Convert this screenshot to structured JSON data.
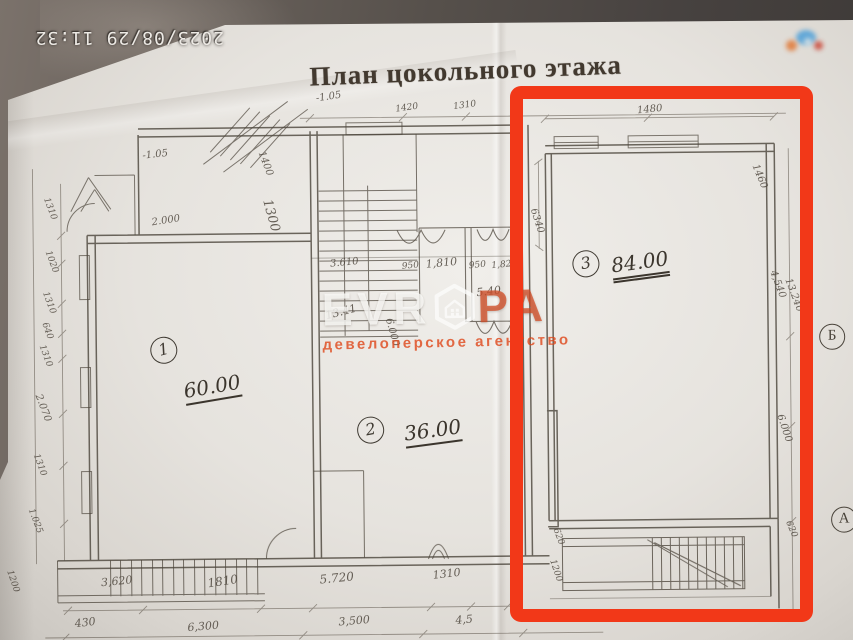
{
  "camera": {
    "timestamp": "2023/08/29  11:32"
  },
  "plan": {
    "title": "План цокольного этажа",
    "rooms": [
      {
        "number": "1",
        "area": "60.00"
      },
      {
        "number": "2",
        "area": "36.00"
      },
      {
        "number": "3",
        "area": "84.00"
      }
    ],
    "axis_markers": [
      "Б",
      "А"
    ],
    "dimensions": [
      {
        "t": "1420",
        "x": 409,
        "y": 108,
        "r": -7,
        "f": 9
      },
      {
        "t": "1310",
        "x": 467,
        "y": 106,
        "r": -7,
        "f": 9
      },
      {
        "t": "1480",
        "x": 652,
        "y": 112,
        "r": -5,
        "f": 10
      },
      {
        "t": "1460",
        "x": 761,
        "y": 180,
        "r": 68,
        "f": 10
      },
      {
        "t": "6340",
        "x": 538,
        "y": 222,
        "r": 73,
        "f": 10
      },
      {
        "t": "-1.05",
        "x": 331,
        "y": 96,
        "r": -8,
        "f": 10
      },
      {
        "t": "-1.05",
        "x": 157,
        "y": 152,
        "r": -6,
        "f": 10
      },
      {
        "t": "1400",
        "x": 267,
        "y": 162,
        "r": 70,
        "f": 10
      },
      {
        "t": "1300",
        "x": 272,
        "y": 214,
        "r": 75,
        "f": 13
      },
      {
        "t": "2.000",
        "x": 167,
        "y": 218,
        "r": -8,
        "f": 10
      },
      {
        "t": "1310",
        "x": 51,
        "y": 205,
        "r": 70,
        "f": 9
      },
      {
        "t": "1020",
        "x": 52,
        "y": 258,
        "r": 70,
        "f": 9
      },
      {
        "t": "1310",
        "x": 49,
        "y": 299,
        "r": 70,
        "f": 9
      },
      {
        "t": "640",
        "x": 47,
        "y": 327,
        "r": 70,
        "f": 9
      },
      {
        "t": "1310",
        "x": 45,
        "y": 352,
        "r": 70,
        "f": 9
      },
      {
        "t": "2.070",
        "x": 42,
        "y": 404,
        "r": 70,
        "f": 10
      },
      {
        "t": "1310",
        "x": 38,
        "y": 461,
        "r": 70,
        "f": 9
      },
      {
        "t": "1.025",
        "x": 33,
        "y": 517,
        "r": 70,
        "f": 9
      },
      {
        "t": "1200",
        "x": 10,
        "y": 577,
        "r": 72,
        "f": 9
      },
      {
        "t": "3.610",
        "x": 345,
        "y": 262,
        "r": -5,
        "f": 10
      },
      {
        "t": "950",
        "x": 411,
        "y": 266,
        "r": -5,
        "f": 9
      },
      {
        "t": "1,810",
        "x": 442,
        "y": 263,
        "r": -5,
        "f": 11
      },
      {
        "t": "950",
        "x": 478,
        "y": 266,
        "r": -5,
        "f": 9
      },
      {
        "t": "1,82",
        "x": 502,
        "y": 266,
        "r": -5,
        "f": 9
      },
      {
        "t": "5.40",
        "x": 489,
        "y": 292,
        "r": -6,
        "f": 11
      },
      {
        "t": "13.41",
        "x": 341,
        "y": 311,
        "r": -14,
        "f": 11
      },
      {
        "t": "6.000",
        "x": 392,
        "y": 332,
        "r": 75,
        "f": 10
      },
      {
        "t": "4,540",
        "x": 778,
        "y": 288,
        "r": 70,
        "f": 10
      },
      {
        "t": "13.240",
        "x": 794,
        "y": 299,
        "r": 70,
        "f": 10
      },
      {
        "t": "6.000",
        "x": 783,
        "y": 432,
        "r": 72,
        "f": 10
      },
      {
        "t": "620",
        "x": 789,
        "y": 533,
        "r": 68,
        "f": 9
      },
      {
        "t": "620",
        "x": 556,
        "y": 538,
        "r": 70,
        "f": 9
      },
      {
        "t": "1200",
        "x": 553,
        "y": 572,
        "r": 72,
        "f": 9
      },
      {
        "t": "3,620",
        "x": 114,
        "y": 578,
        "r": -5,
        "f": 11
      },
      {
        "t": "1810",
        "x": 220,
        "y": 579,
        "r": -8,
        "f": 12
      },
      {
        "t": "5.720",
        "x": 334,
        "y": 577,
        "r": -5,
        "f": 12
      },
      {
        "t": "1310",
        "x": 444,
        "y": 574,
        "r": -6,
        "f": 11
      },
      {
        "t": "430",
        "x": 82,
        "y": 619,
        "r": -6,
        "f": 11
      },
      {
        "t": "6,300",
        "x": 200,
        "y": 624,
        "r": -4,
        "f": 11
      },
      {
        "t": "3,500",
        "x": 351,
        "y": 620,
        "r": -4,
        "f": 11
      },
      {
        "t": "4,5",
        "x": 461,
        "y": 620,
        "r": -4,
        "f": 11
      }
    ]
  },
  "watermark": {
    "brand_prefix": "EVR",
    "brand_suffix": "PA",
    "logo": "hexagon-house-icon",
    "subtitle": "девелоперское  агентство",
    "accent_color": "#de461a"
  },
  "highlight": {
    "shape": "rectangle",
    "color": "#f23818",
    "marked_room": "3"
  }
}
